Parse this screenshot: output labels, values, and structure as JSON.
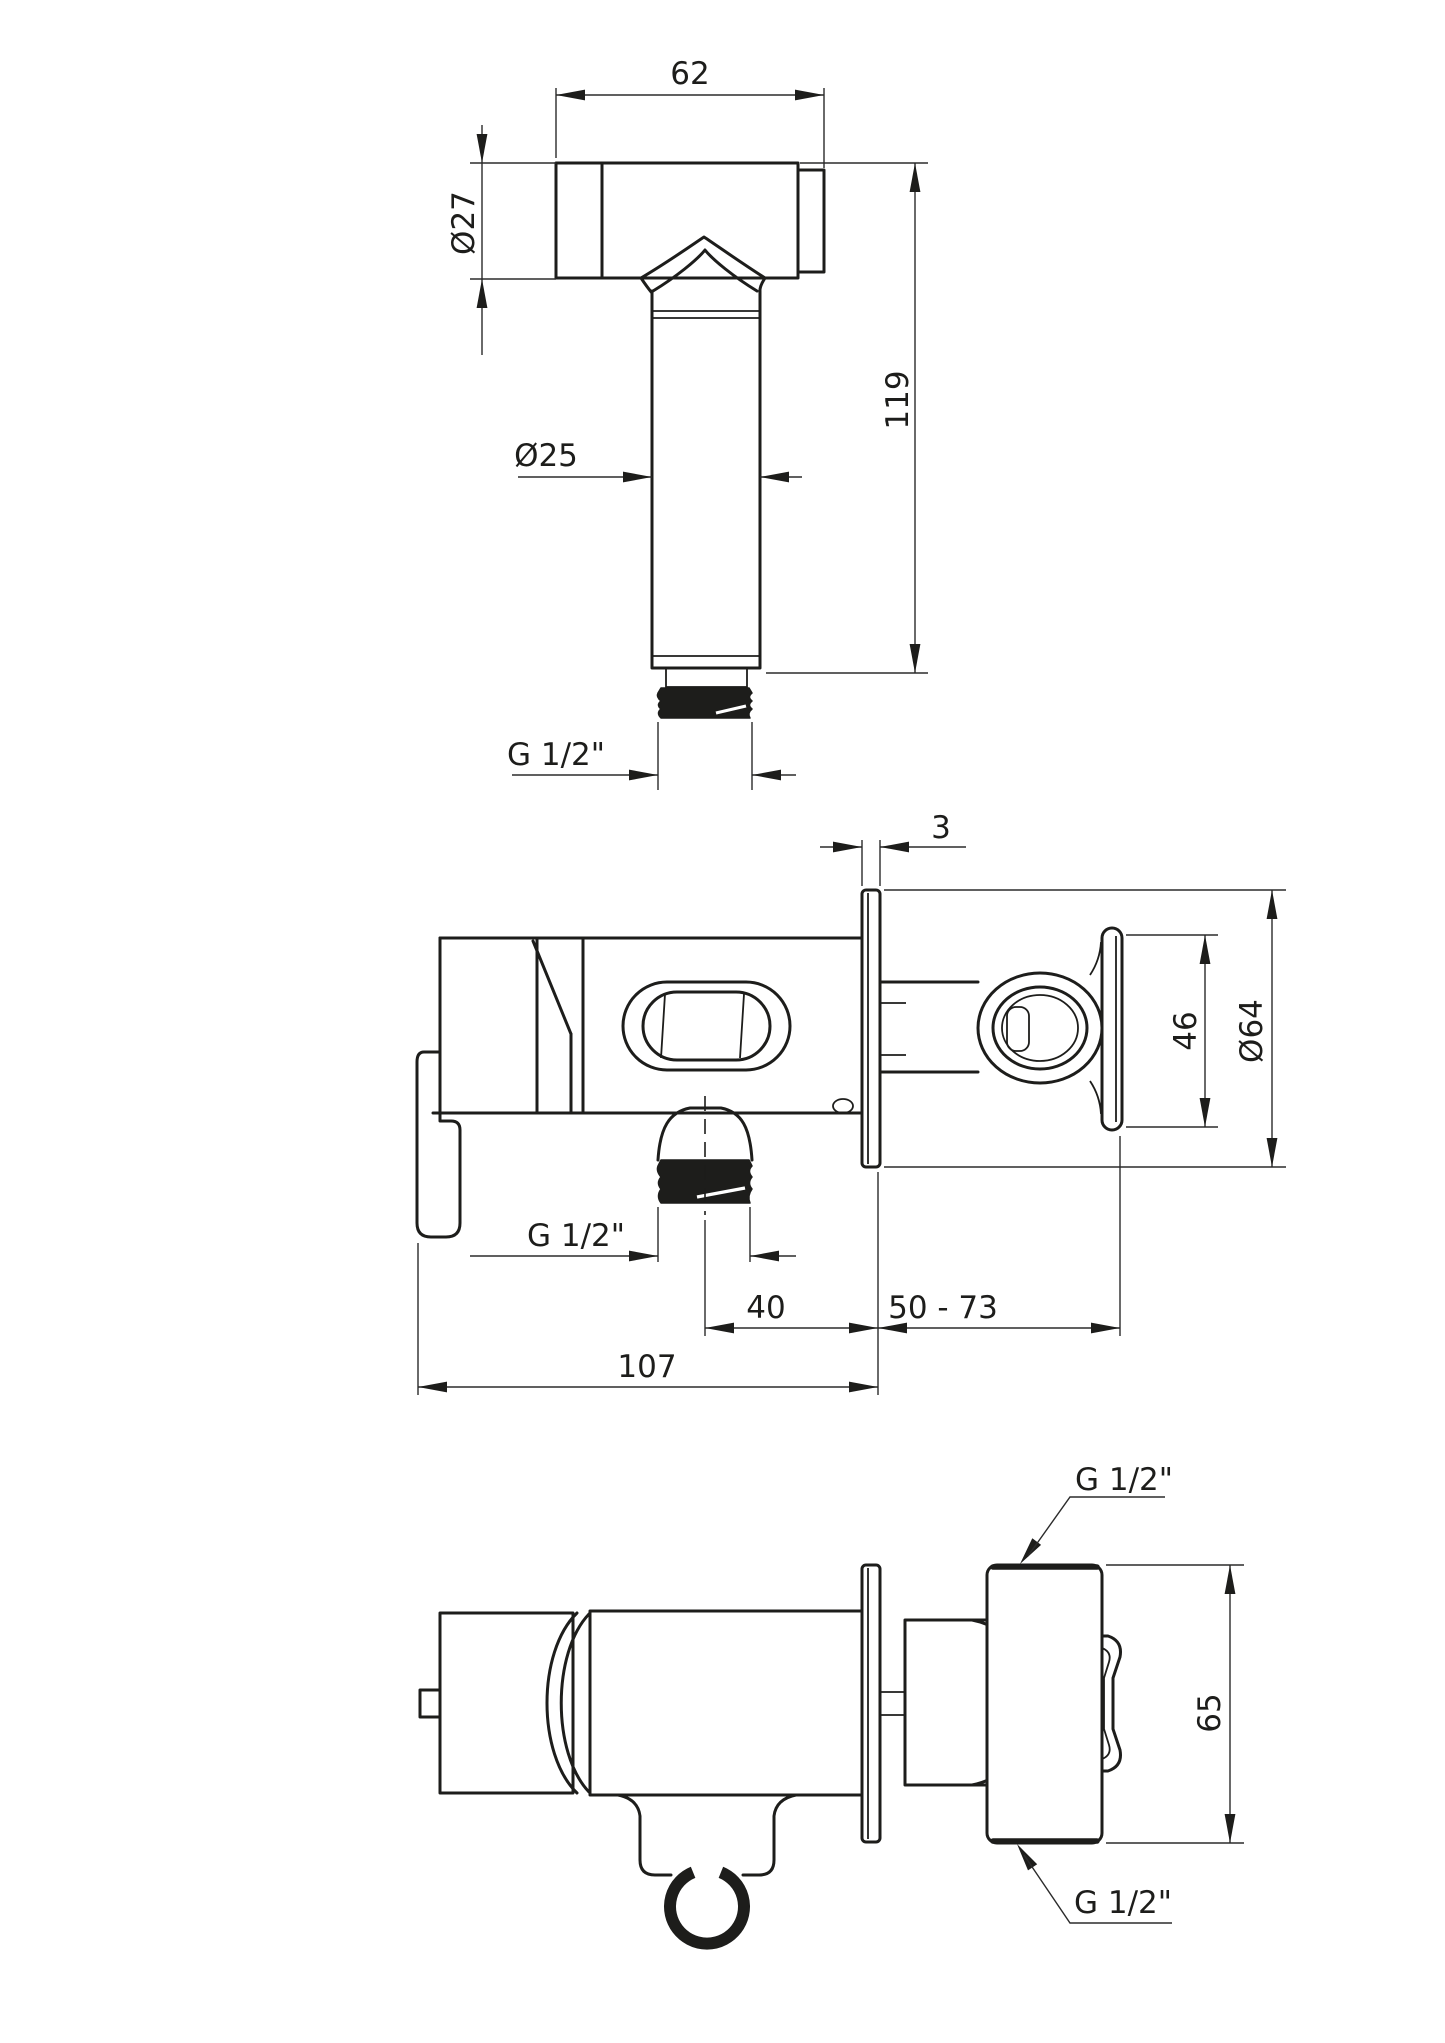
{
  "drawing_type": "technical-dimension-drawing",
  "colors": {
    "line": "#1d1d1b",
    "background": "#ffffff"
  },
  "labels": {
    "hand_shower": {
      "head_width": "62",
      "head_diameter": "Ø27",
      "handle_diameter": "Ø25",
      "length": "119",
      "thread": "G 1/2\""
    },
    "side_view": {
      "plate_thickness": "3",
      "holder_height": "46",
      "plate_diameter": "Ø64",
      "outlet_thread": "G 1/2\"",
      "outlet_to_wall": "40",
      "wall_depth_range": "50 - 73",
      "total_width": "107"
    },
    "top_view": {
      "inlet_thread_top": "G 1/2\"",
      "body_depth": "65",
      "inlet_thread_bottom": "G 1/2\""
    }
  }
}
